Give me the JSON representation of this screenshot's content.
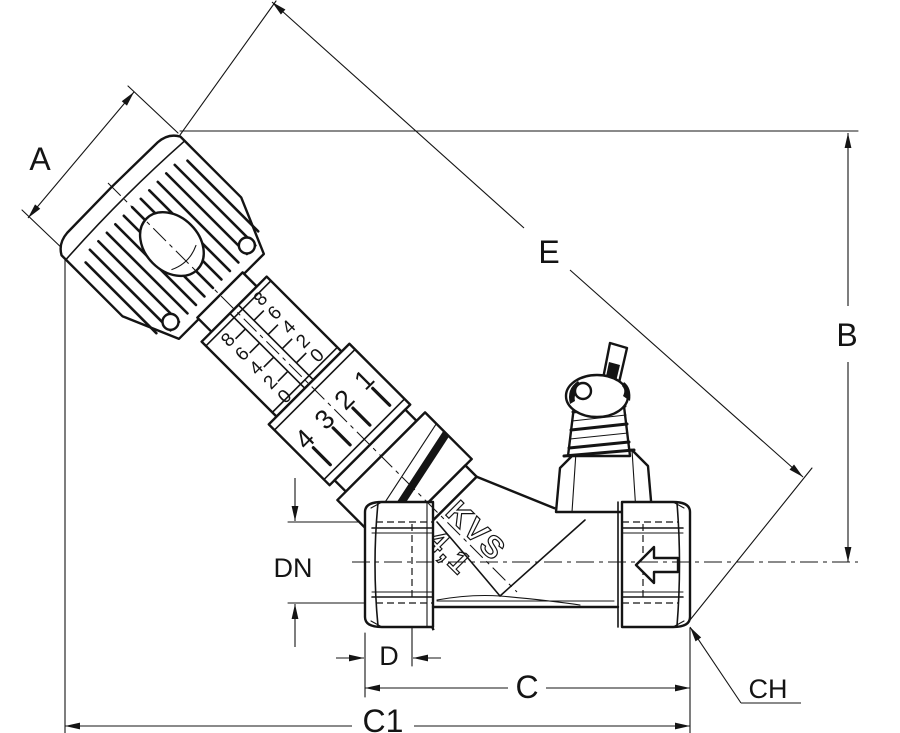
{
  "drawing": {
    "dimensions": {
      "a": "A",
      "b": "B",
      "c": "C",
      "c1": "C1",
      "d": "D",
      "dn": "DN",
      "e": "E",
      "ch": "CH"
    },
    "body_marking": {
      "line1": "KVS",
      "line2": "4,1"
    },
    "handwheel_scale": {
      "fine_upper": [
        "8",
        "6",
        "4",
        "2",
        "0"
      ],
      "fine_lower": [
        "8",
        "6",
        "4",
        "2",
        "0"
      ],
      "turn_marks": [
        "4",
        "3",
        "2",
        "1"
      ]
    },
    "icons": {
      "flow_direction": "arrow-left"
    },
    "colors": {
      "line": "#141414",
      "background": "#ffffff"
    }
  }
}
